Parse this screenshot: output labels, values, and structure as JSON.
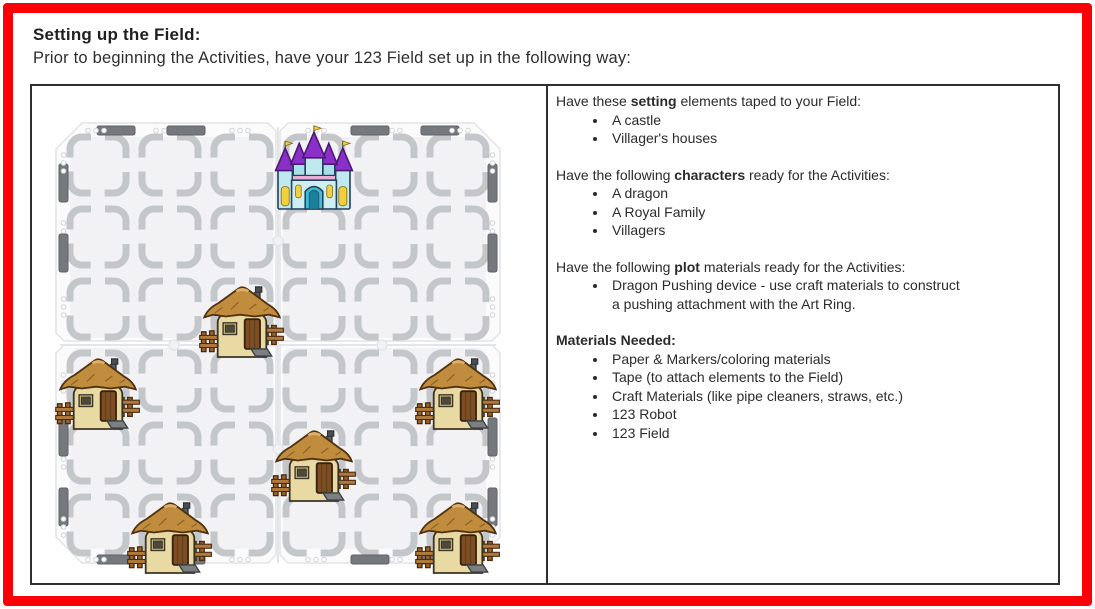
{
  "page": {
    "title": "Setting up the Field:",
    "subtitle": "Prior to beginning the Activities, have your 123 Field set up in the following way:",
    "border_color": "#fb0007"
  },
  "panel": {
    "sections": [
      {
        "intro_prefix": "Have these ",
        "intro_bold": "setting",
        "intro_suffix": " elements taped to your Field:",
        "items": [
          "A castle",
          "Villager's houses"
        ]
      },
      {
        "intro_prefix": "Have the following ",
        "intro_bold": "characters",
        "intro_suffix": " ready for the Activities:",
        "items": [
          "A dragon",
          "A Royal Family",
          "Villagers"
        ]
      },
      {
        "intro_prefix": "Have the following ",
        "intro_bold": "plot",
        "intro_suffix": " materials ready for the Activities:",
        "items": [
          "Dragon Pushing device - use craft materials to construct a pushing attachment with the Art Ring."
        ]
      },
      {
        "intro_prefix": "",
        "intro_bold": "Materials Needed:",
        "intro_suffix": "",
        "items": [
          "Paper & Markers/coloring materials",
          "Tape (to attach elements to the Field)",
          "Craft Materials (like pipe cleaners, straws, etc.)",
          "123 Robot",
          "123 Field"
        ]
      }
    ]
  },
  "field": {
    "grid": {
      "rows": 6,
      "cols": 6
    },
    "castle": {
      "label": "castle",
      "row": 1,
      "col": 4
    },
    "houses": [
      {
        "label": "villager-house",
        "row": 3,
        "col": 3
      },
      {
        "label": "villager-house",
        "row": 4,
        "col": 1
      },
      {
        "label": "villager-house",
        "row": 4,
        "col": 6
      },
      {
        "label": "villager-house",
        "row": 5,
        "col": 4
      },
      {
        "label": "villager-house",
        "row": 6,
        "col": 2
      },
      {
        "label": "villager-house",
        "row": 6,
        "col": 6
      }
    ],
    "colors": {
      "panel_fill": "#fbfbfc",
      "panel_inner": "#f2f2f4",
      "panel_edge": "#e2e3e6",
      "tile_stroke": "#c4c7ca",
      "tab_fill": "#75787c",
      "tab_edge": "#5f6266",
      "hole_stroke": "#d2d3d6",
      "seam": "#e4e5e7"
    }
  }
}
